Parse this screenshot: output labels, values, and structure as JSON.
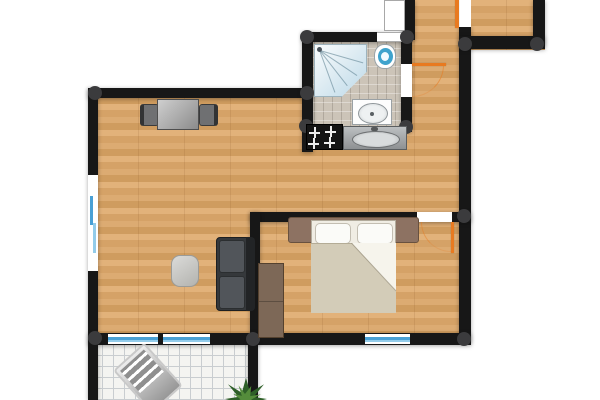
{
  "scene": {
    "type": "apartment-floor-plan",
    "view": "top-down",
    "canvas": {
      "width": 600,
      "height": 400
    }
  },
  "colors": {
    "wall": "#171717",
    "corner_joint": "#3b3b3d",
    "wood_floor": "#dcab72",
    "bathroom_tile": "#ccc4b8",
    "balcony_tile": "#f4f4f1",
    "window_glass": "#49a0d5",
    "door": "#e87a20"
  },
  "rooms": [
    {
      "name": "Living room with kitchen",
      "floor": "wood",
      "furniture": [
        "desk with two chairs",
        "sofa",
        "side table",
        "cooktop with four burners",
        "kitchen sink"
      ]
    },
    {
      "name": "Bathroom",
      "floor": "tile",
      "furniture": [
        "corner shower",
        "toilet",
        "washbasin"
      ]
    },
    {
      "name": "Bedroom",
      "floor": "wood",
      "furniture": [
        "double bed with two pillows and folded blanket",
        "headboard with nightstands",
        "wardrobe"
      ]
    },
    {
      "name": "Hallway",
      "floor": "wood",
      "furniture": []
    },
    {
      "name": "Entry nook",
      "floor": "wood",
      "furniture": []
    },
    {
      "name": "Balcony",
      "floor": "grid tile",
      "furniture": [
        "sun lounger",
        "potted plant"
      ]
    }
  ],
  "openings": {
    "doors": [
      {
        "name": "entrance-door",
        "color": "#e87a20"
      },
      {
        "name": "bathroom-door",
        "color": "#e87a20"
      },
      {
        "name": "bedroom-door",
        "color": "#e87a20"
      }
    ],
    "windows": [
      {
        "name": "living-room-left-window"
      },
      {
        "name": "balcony-window-1"
      },
      {
        "name": "balcony-window-2"
      },
      {
        "name": "bedroom-window"
      },
      {
        "name": "bathroom-window"
      }
    ]
  }
}
